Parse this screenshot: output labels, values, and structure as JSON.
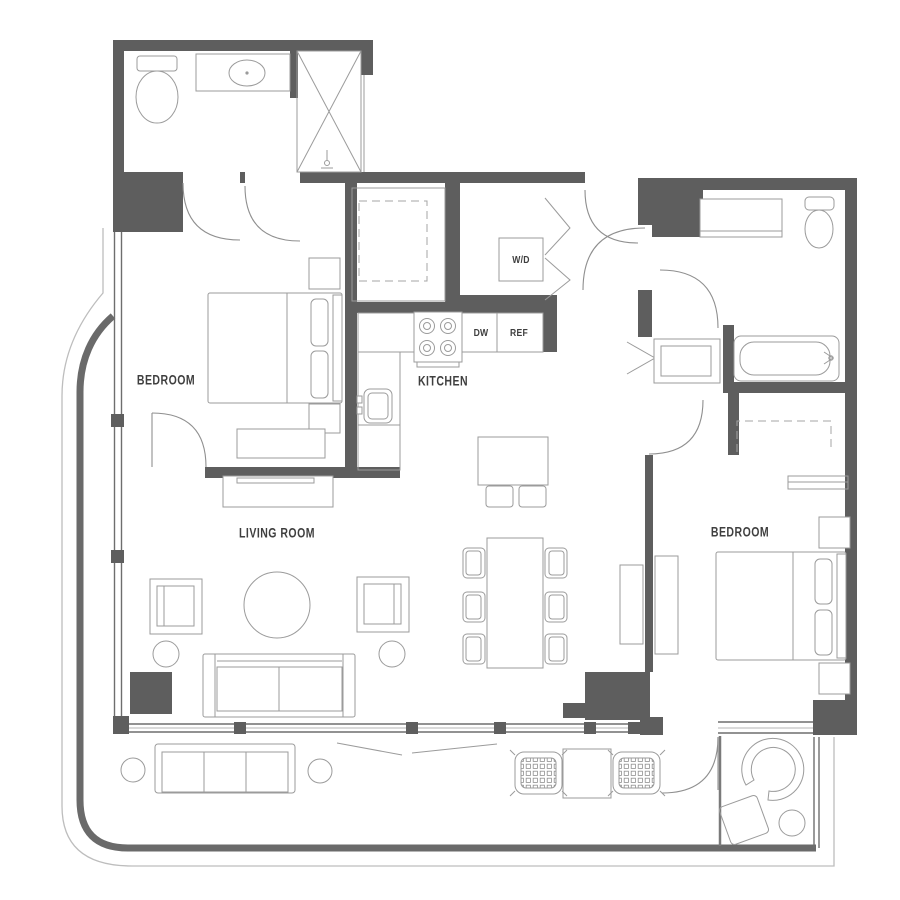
{
  "floor_plan": {
    "rooms": {
      "bedroom_left": {
        "label": "BEDROOM"
      },
      "kitchen": {
        "label": "KITCHEN"
      },
      "living_room": {
        "label": "LIVING ROOM"
      },
      "bedroom_right": {
        "label": "BEDROOM"
      }
    },
    "appliances": {
      "washer_dryer": {
        "label": "W/D"
      },
      "dishwasher": {
        "label": "DW"
      },
      "refrigerator": {
        "label": "REF"
      }
    },
    "colors": {
      "wall": "#5e5e5e",
      "fixture_line": "#9b9b9b",
      "window_line": "#6e6e6e",
      "balcony_wall": "#6a6a6a",
      "label_text": "#3f3f3f",
      "background": "#ffffff"
    }
  }
}
